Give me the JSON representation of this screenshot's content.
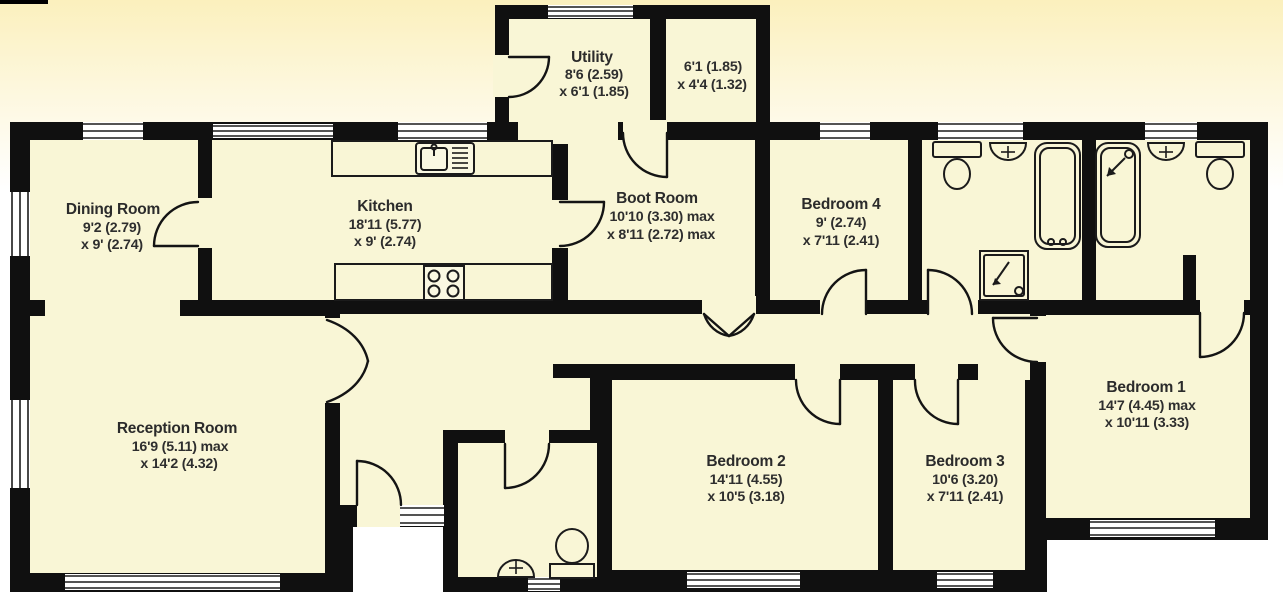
{
  "plan": {
    "type": "floorplan",
    "wall_color": "#101010",
    "floor_color": "#f9f6d6",
    "background_tint": "#fbf0bd",
    "rooms": [
      {
        "id": "utility",
        "name": "Utility",
        "dims": [
          "8'6 (2.59)",
          "x 6'1 (1.85)"
        ]
      },
      {
        "id": "store",
        "name": "",
        "dims": [
          "6'1 (1.85)",
          "x 4'4 (1.32)"
        ]
      },
      {
        "id": "dining",
        "name": "Dining Room",
        "dims": [
          "9'2 (2.79)",
          "x 9' (2.74)"
        ]
      },
      {
        "id": "kitchen",
        "name": "Kitchen",
        "dims": [
          "18'11 (5.77)",
          "x 9' (2.74)"
        ]
      },
      {
        "id": "boot",
        "name": "Boot Room",
        "dims": [
          "10'10 (3.30) max",
          "x 8'11 (2.72) max"
        ]
      },
      {
        "id": "bedroom4",
        "name": "Bedroom 4",
        "dims": [
          "9' (2.74)",
          "x 7'11 (2.41)"
        ]
      },
      {
        "id": "reception",
        "name": "Reception Room",
        "dims": [
          "16'9 (5.11) max",
          "x 14'2 (4.32)"
        ]
      },
      {
        "id": "bedroom2",
        "name": "Bedroom 2",
        "dims": [
          "14'11 (4.55)",
          "x 10'5 (3.18)"
        ]
      },
      {
        "id": "bedroom3",
        "name": "Bedroom 3",
        "dims": [
          "10'6 (3.20)",
          "x 7'11 (2.41)"
        ]
      },
      {
        "id": "bedroom1",
        "name": "Bedroom 1",
        "dims": [
          "14'7 (4.45) max",
          "x 10'11 (3.33)"
        ]
      }
    ],
    "fixtures": [
      "kitchen-sink",
      "hob",
      "bath",
      "shower-bath",
      "shower",
      "toilet",
      "toilet",
      "toilet",
      "basin",
      "basin",
      "basin"
    ]
  }
}
